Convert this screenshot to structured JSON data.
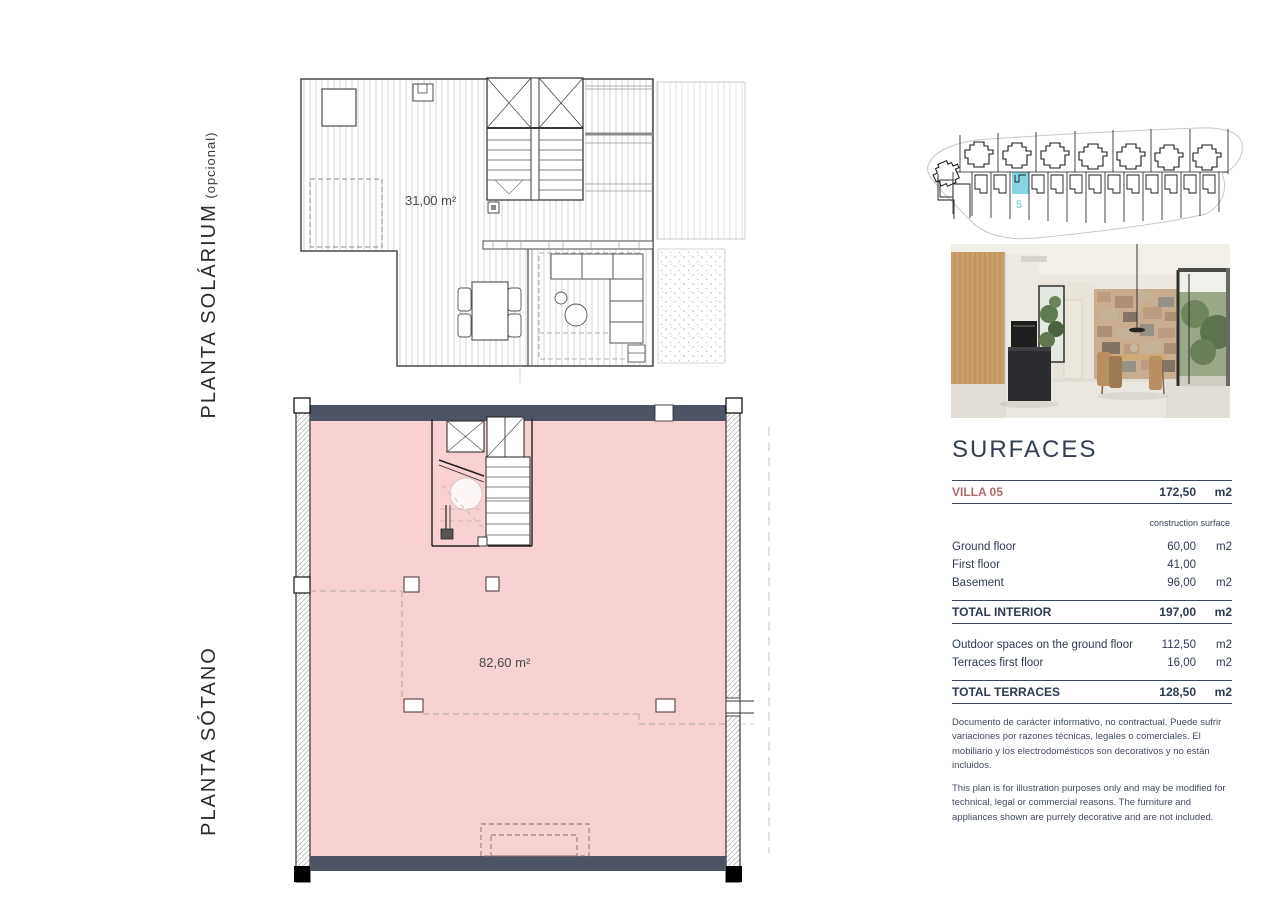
{
  "labels": {
    "solarium_title": "PLANTA SOLÁRIUM",
    "solarium_suffix": " (opcional)",
    "sotano_title": "PLANTA SÓTANO"
  },
  "solarium_plan": {
    "area": "31,00 m²"
  },
  "basement_plan": {
    "area": "82,60 m²"
  },
  "site_plan": {
    "plot_number": "5"
  },
  "surfaces": {
    "title": "SURFACES",
    "villa_row": {
      "label": "VILLA 05",
      "value": "172,50",
      "unit": "m2"
    },
    "column_note": "construction surface",
    "rows": [
      {
        "label": "Ground floor",
        "value": "60,00",
        "unit": "m2"
      },
      {
        "label": "First floor",
        "value": "41,00",
        "unit": ""
      },
      {
        "label": "Basement",
        "value": "96,00",
        "unit": "m2"
      }
    ],
    "total_interior": {
      "label": "TOTAL INTERIOR",
      "value": "197,00",
      "unit": "m2"
    },
    "outdoor_rows": [
      {
        "label": "Outdoor spaces on the ground floor",
        "value": "112,50",
        "unit": "m2"
      },
      {
        "label": "Terraces first floor",
        "value": "16,00",
        "unit": "m2"
      }
    ],
    "total_terraces": {
      "label": "TOTAL TERRACES",
      "value": "128,50",
      "unit": "m2"
    }
  },
  "disclaimer": {
    "spanish": "Documento de carácter informativo, no contractual. Puede sufrir variaciones por razones técnicas, legales o comerciales. El mobiliario y los electrodomésticos son decorativos y no están incluidos.",
    "english": "This plan is for illustration purposes only and may be modified for technical, legal or commercial reasons. The furniture and appliances shown are purrely decorative and are not included."
  },
  "colors": {
    "basement_fill": "#f8d2d2",
    "structural_wall": "#4d5464",
    "plot_highlight": "#85d6e0",
    "villa_accent": "#b16a6a",
    "table_ink": "#2e3a52"
  }
}
